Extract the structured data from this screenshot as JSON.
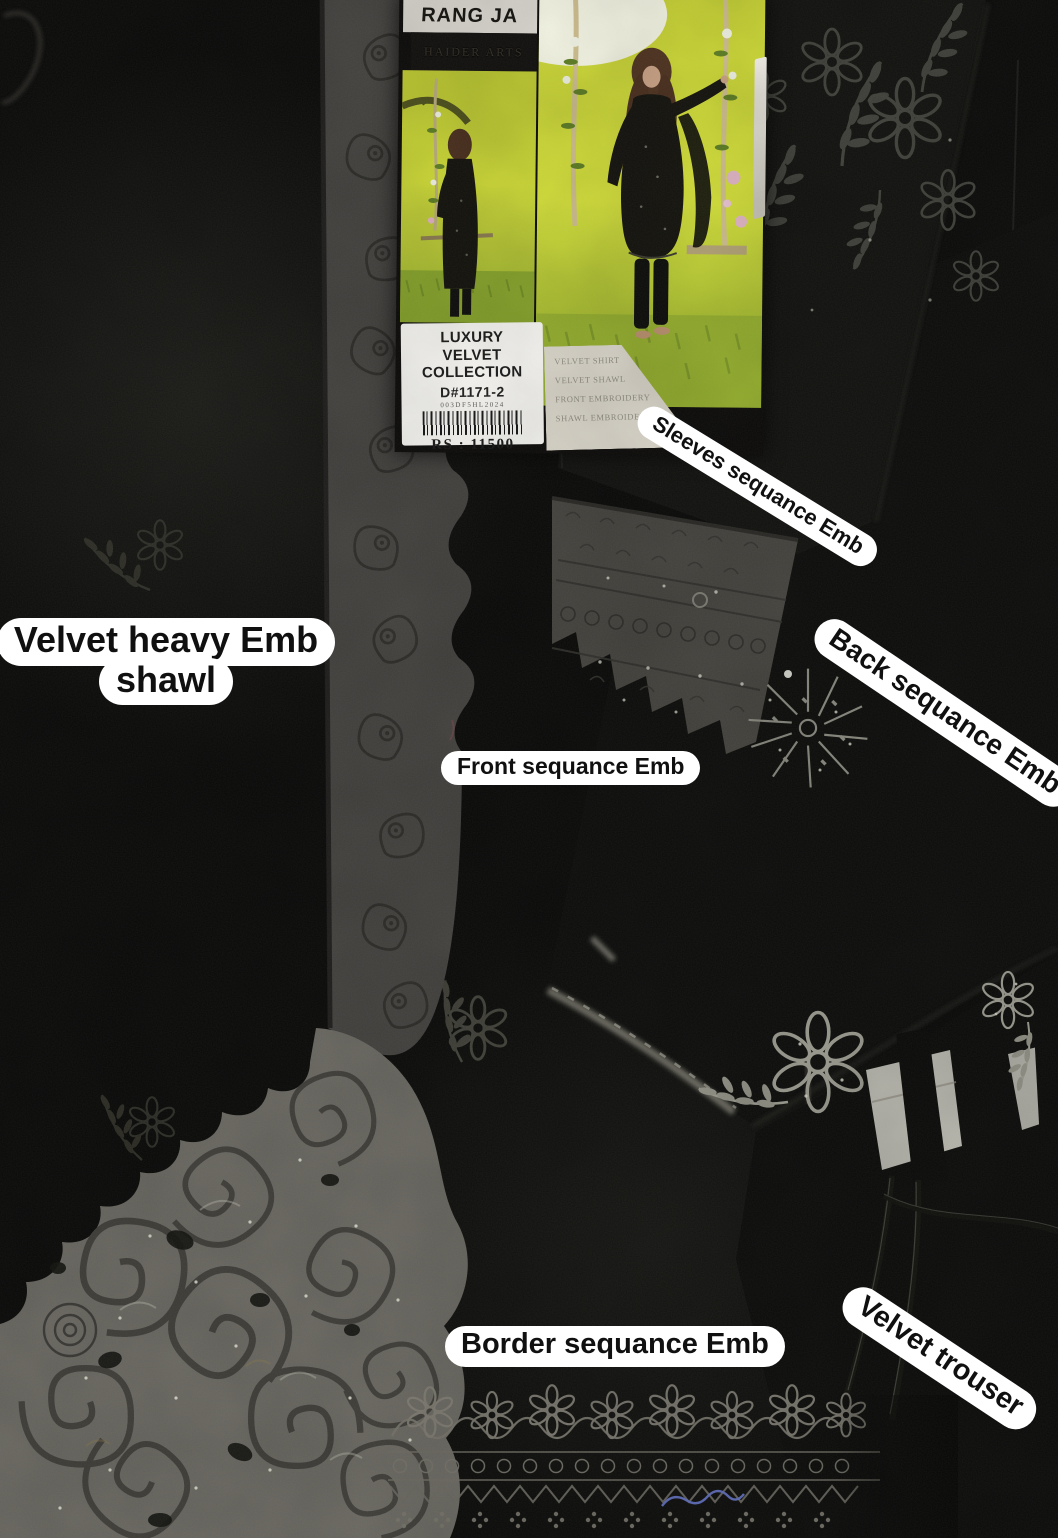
{
  "annotations": {
    "shawl_line1": "Velvet heavy Emb",
    "shawl_line2": "shawl",
    "sleeves": "Sleeves sequance Emb",
    "back": "Back sequance Emb",
    "front": "Front sequance Emb",
    "border": "Border sequance Emb",
    "trouser": "Velvet trouser"
  },
  "brand_card": {
    "brand": "RANG JA",
    "maker": "HAIDER ARTS",
    "collection": "LUXURY VELVET COLLECTION",
    "design_no": "D#1171-2",
    "lot_code": "003DF5HL2024",
    "price": "RS : 11500",
    "contents": [
      "VELVET SHIRT",
      "VELVET SHAWL",
      "FRONT EMBROIDERY",
      "SHAWL EMBROIDERY"
    ]
  },
  "colors": {
    "sticker_bg": "#ffffff",
    "sticker_text": "#101010",
    "velvet_black": "#0a0a09",
    "embroidery_gray": "#8d8b82",
    "lace_gray": "#6b6962",
    "card_yellow": "#c9d434",
    "label_white": "#f6f5f1"
  }
}
